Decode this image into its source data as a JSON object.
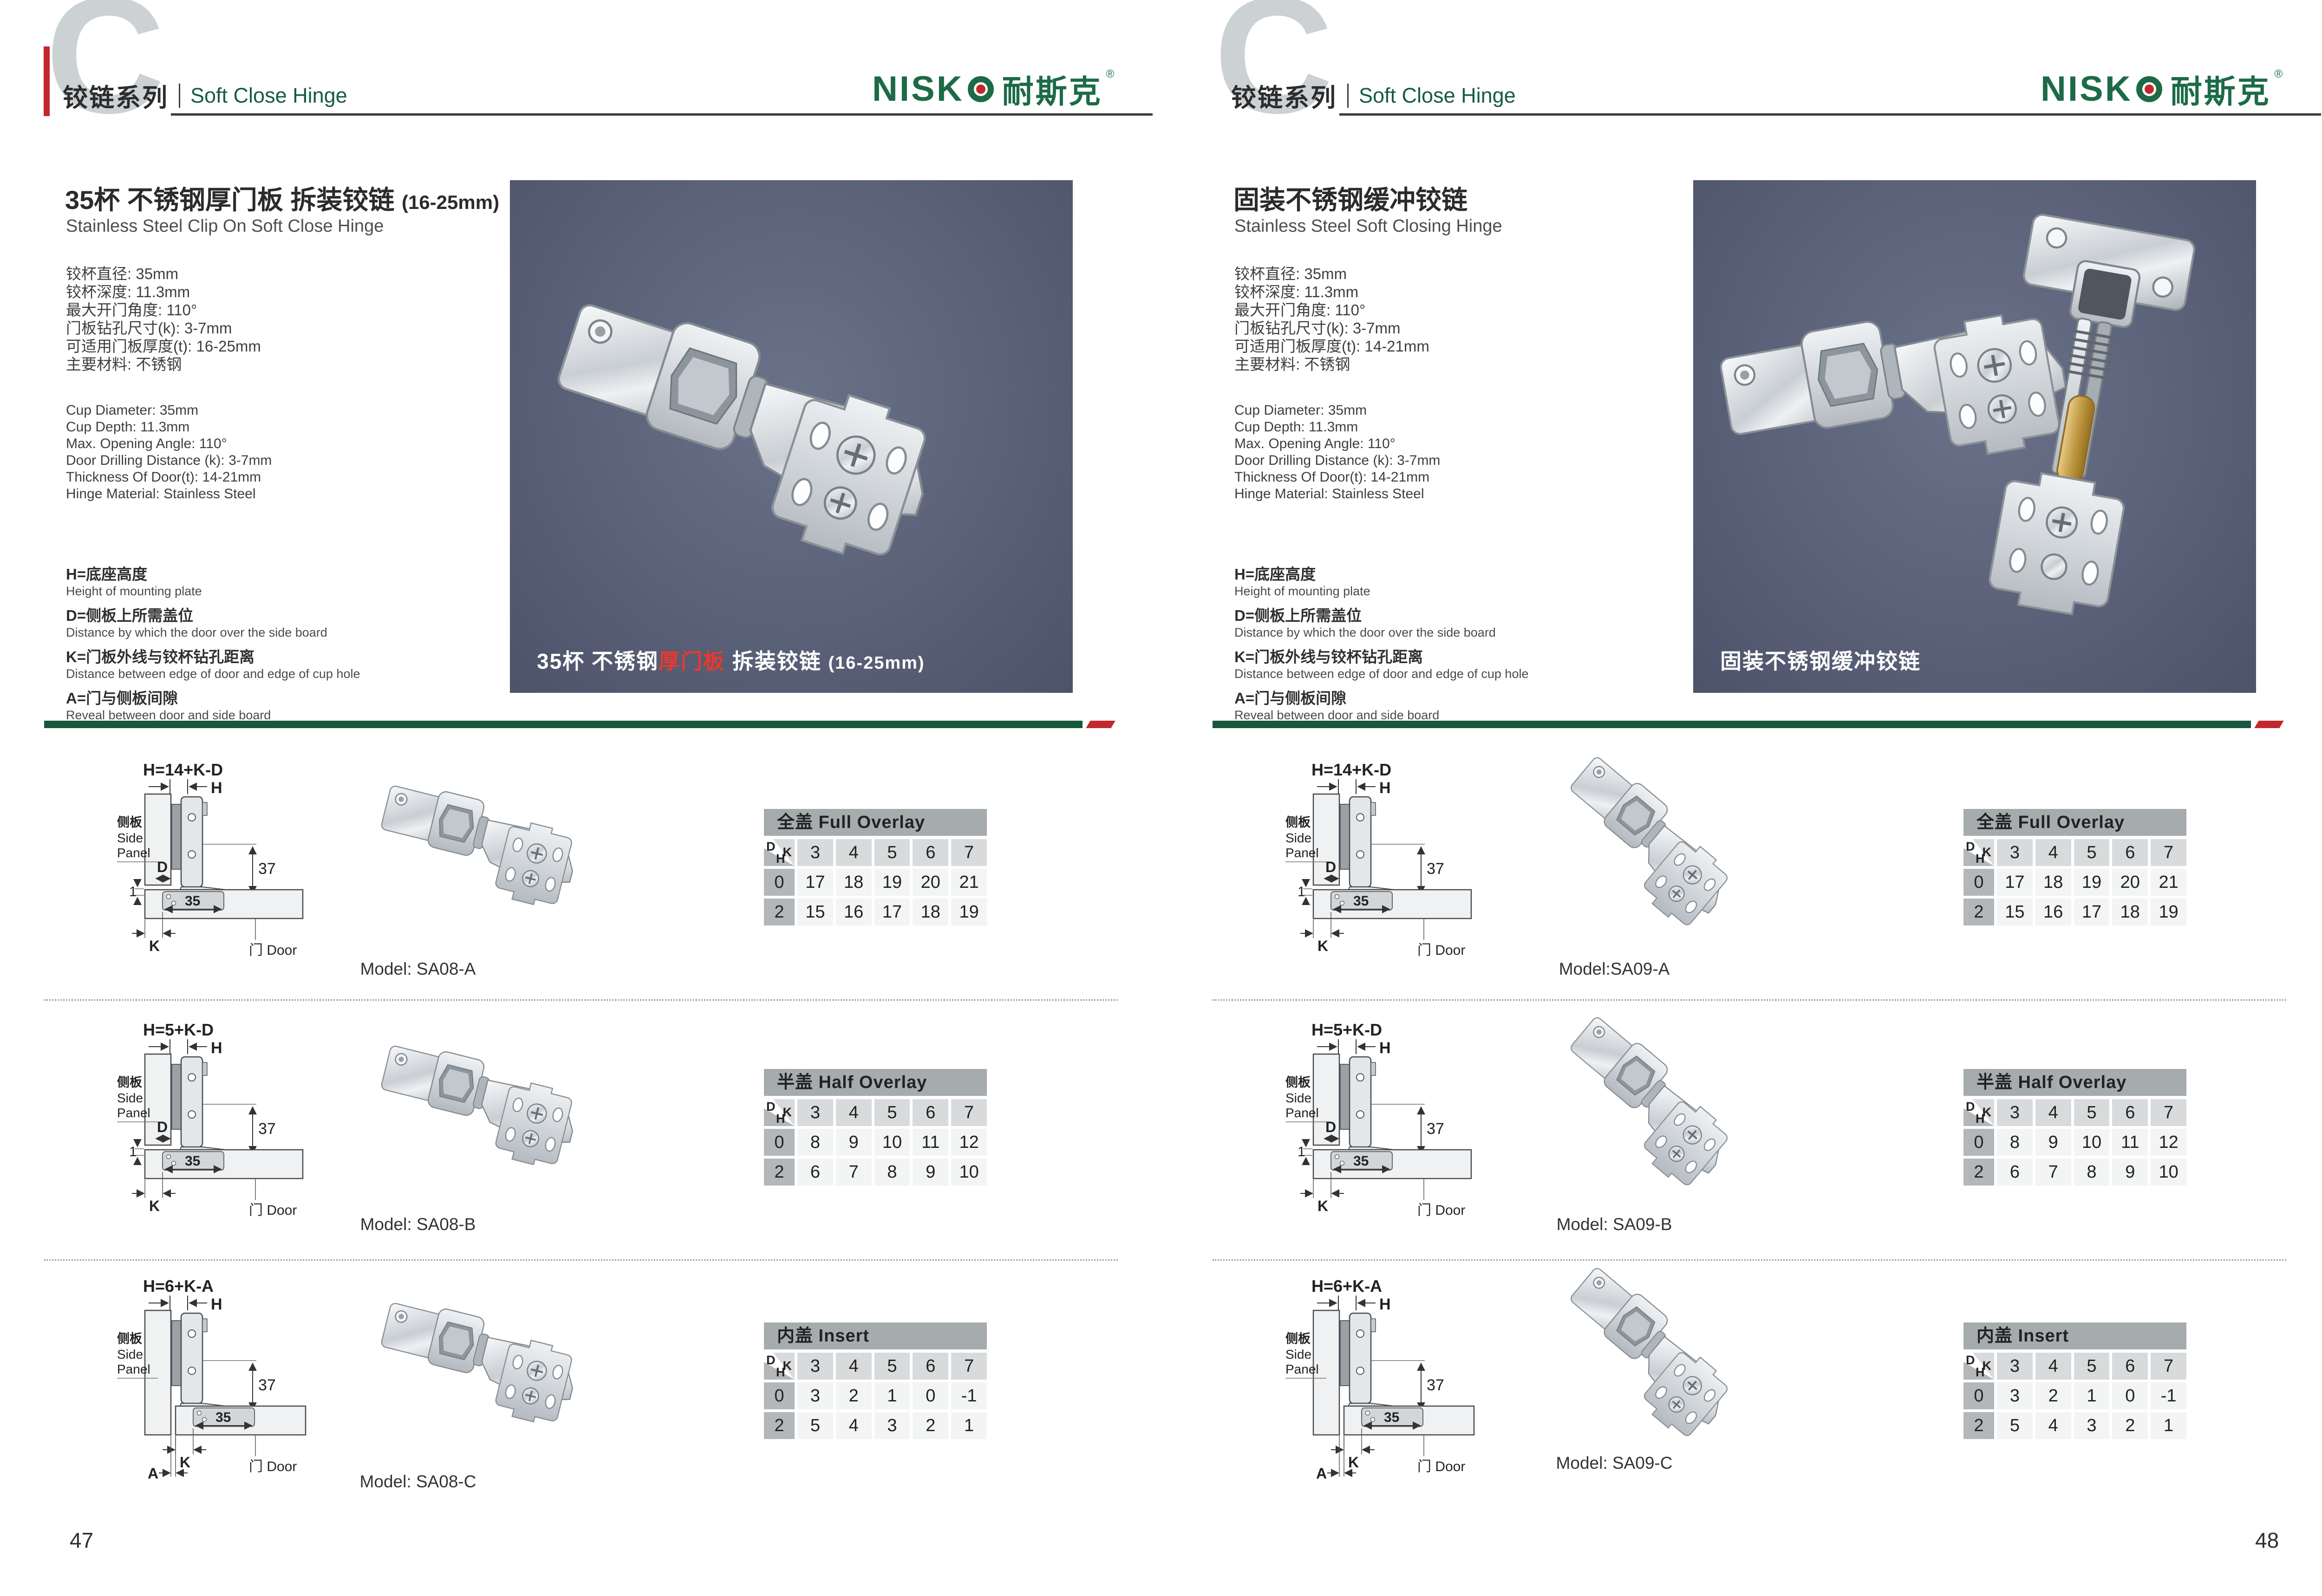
{
  "brand": {
    "name": "NISKO",
    "logo_latin": "NISK",
    "logo_cn": "耐斯克",
    "logo_reg": "®",
    "green": "#1d6b46",
    "red": "#c1272d"
  },
  "header": {
    "big_letter": "C",
    "series_cn": "铰链系列",
    "series_en": "Soft Close Hinge"
  },
  "legend": [
    {
      "cn": "H=底座高度",
      "en": "Height of mounting plate"
    },
    {
      "cn": "D=侧板上所需盖位",
      "en": "Distance by which the door over the side board"
    },
    {
      "cn": "K=门板外线与铰杯钻孔距离",
      "en": "Distance between edge of door and edge of cup hole"
    },
    {
      "cn": "A=门与侧板间隙",
      "en": "Reveal between door and side board"
    }
  ],
  "diagram_labels": {
    "side_panel_cn": "侧板",
    "side_panel_en1": "Side",
    "side_panel_en2": "Panel",
    "door": "门 Door",
    "h": "H",
    "d": "D",
    "k": "K",
    "a": "A",
    "gap": "1",
    "cup_width": "35",
    "height37": "37"
  },
  "pages": {
    "left": {
      "page_number": "47",
      "title_cn": "35杯 不锈钢厚门板 拆装铰链",
      "title_suffix": "(16-25mm)",
      "title_en": "Stainless Steel Clip On Soft Close Hinge",
      "specs_cn": [
        "铰杯直径: 35mm",
        "铰杯深度: 11.3mm",
        "最大开门角度: 110°",
        "门板钻孔尺寸(k): 3-7mm",
        "可适用门板厚度(t): 16-25mm",
        "主要材料: 不锈钢"
      ],
      "specs_en": [
        "Cup Diameter: 35mm",
        "Cup Depth: 11.3mm",
        "Max. Opening Angle: 110°",
        "Door Drilling Distance (k): 3-7mm",
        "Thickness Of Door(t): 14-21mm",
        "Hinge Material: Stainless Steel"
      ],
      "photo_caption": [
        {
          "text": "35杯 不锈钢"
        },
        {
          "text": "厚门板",
          "red": true
        },
        {
          "text": " 拆装铰链 "
        },
        {
          "text": "(16-25mm)",
          "small": true
        }
      ],
      "sections": [
        {
          "model": "Model: SA08-A",
          "diagram": {
            "formula": "H=14+K-D",
            "variant": "overlay"
          },
          "table": {
            "title": "全盖 Full Overlay",
            "corner": {
              "d": "D",
              "k": "K",
              "h": "H"
            },
            "cols": [
              "3",
              "4",
              "5",
              "6",
              "7"
            ],
            "rows": [
              {
                "h": "0",
                "vals": [
                  "17",
                  "18",
                  "19",
                  "20",
                  "21"
                ]
              },
              {
                "h": "2",
                "vals": [
                  "15",
                  "16",
                  "17",
                  "18",
                  "19"
                ]
              }
            ]
          }
        },
        {
          "model": "Model: SA08-B",
          "diagram": {
            "formula": "H=5+K-D",
            "variant": "overlay"
          },
          "table": {
            "title": "半盖 Half Overlay",
            "corner": {
              "d": "D",
              "k": "K",
              "h": "H"
            },
            "cols": [
              "3",
              "4",
              "5",
              "6",
              "7"
            ],
            "rows": [
              {
                "h": "0",
                "vals": [
                  "8",
                  "9",
                  "10",
                  "11",
                  "12"
                ]
              },
              {
                "h": "2",
                "vals": [
                  "6",
                  "7",
                  "8",
                  "9",
                  "10"
                ]
              }
            ]
          }
        },
        {
          "model": "Model: SA08-C",
          "diagram": {
            "formula": "H=6+K-A",
            "variant": "insert"
          },
          "table": {
            "title": "内盖 Insert",
            "corner": {
              "d": "D",
              "k": "K",
              "h": "H"
            },
            "cols": [
              "3",
              "4",
              "5",
              "6",
              "7"
            ],
            "rows": [
              {
                "h": "0",
                "vals": [
                  "3",
                  "2",
                  "1",
                  "0",
                  "-1"
                ]
              },
              {
                "h": "2",
                "vals": [
                  "5",
                  "4",
                  "3",
                  "2",
                  "1"
                ]
              }
            ]
          }
        }
      ]
    },
    "right": {
      "page_number": "48",
      "title_cn": "固装不锈钢缓冲铰链",
      "title_suffix": "",
      "title_en": "Stainless Steel Soft Closing Hinge",
      "specs_cn": [
        "铰杯直径: 35mm",
        "铰杯深度: 11.3mm",
        "最大开门角度: 110°",
        "门板钻孔尺寸(k): 3-7mm",
        "可适用门板厚度(t): 14-21mm",
        "主要材料: 不锈钢"
      ],
      "specs_en": [
        "Cup Diameter: 35mm",
        "Cup Depth: 11.3mm",
        "Max. Opening Angle: 110°",
        "Door Drilling Distance (k): 3-7mm",
        "Thickness Of Door(t): 14-21mm",
        "Hinge Material: Stainless Steel"
      ],
      "photo_caption": [
        {
          "text": "固装不锈钢缓冲铰链"
        }
      ],
      "sections": [
        {
          "model": "Model:SA09-A",
          "diagram": {
            "formula": "H=14+K-D",
            "variant": "overlay"
          },
          "table": {
            "title": "全盖 Full Overlay",
            "corner": {
              "d": "D",
              "k": "K",
              "h": "H"
            },
            "cols": [
              "3",
              "4",
              "5",
              "6",
              "7"
            ],
            "rows": [
              {
                "h": "0",
                "vals": [
                  "17",
                  "18",
                  "19",
                  "20",
                  "21"
                ]
              },
              {
                "h": "2",
                "vals": [
                  "15",
                  "16",
                  "17",
                  "18",
                  "19"
                ]
              }
            ]
          }
        },
        {
          "model": "Model: SA09-B",
          "diagram": {
            "formula": "H=5+K-D",
            "variant": "overlay"
          },
          "table": {
            "title": "半盖 Half Overlay",
            "corner": {
              "d": "D",
              "k": "K",
              "h": "H"
            },
            "cols": [
              "3",
              "4",
              "5",
              "6",
              "7"
            ],
            "rows": [
              {
                "h": "0",
                "vals": [
                  "8",
                  "9",
                  "10",
                  "11",
                  "12"
                ]
              },
              {
                "h": "2",
                "vals": [
                  "6",
                  "7",
                  "8",
                  "9",
                  "10"
                ]
              }
            ]
          }
        },
        {
          "model": "Model: SA09-C",
          "diagram": {
            "formula": "H=6+K-A",
            "variant": "insert"
          },
          "table": {
            "title": "内盖 Insert",
            "corner": {
              "d": "D",
              "k": "K",
              "h": "H"
            },
            "cols": [
              "3",
              "4",
              "5",
              "6",
              "7"
            ],
            "rows": [
              {
                "h": "0",
                "vals": [
                  "3",
                  "2",
                  "1",
                  "0",
                  "-1"
                ]
              },
              {
                "h": "2",
                "vals": [
                  "5",
                  "4",
                  "3",
                  "2",
                  "1"
                ]
              }
            ]
          }
        }
      ]
    }
  }
}
